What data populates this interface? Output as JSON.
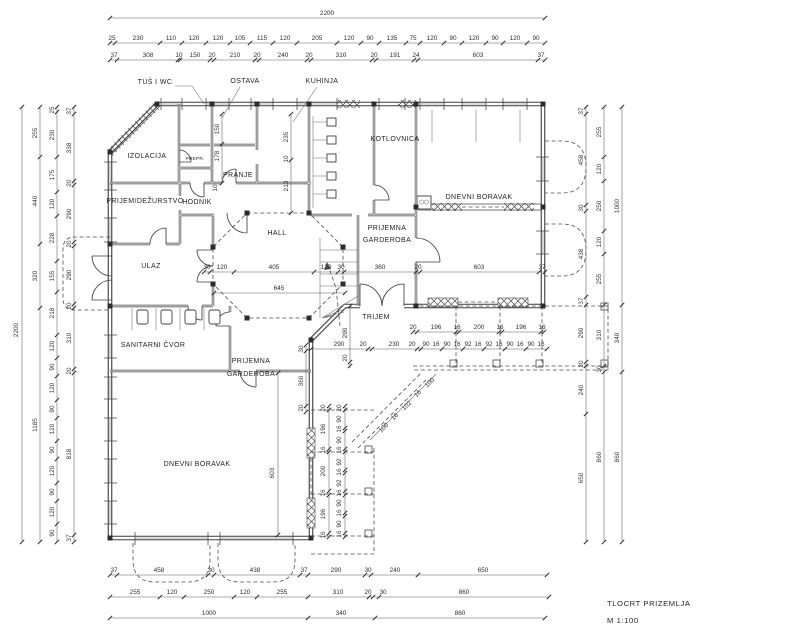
{
  "drawing": {
    "line_color": "#3c3c3c",
    "background": "#ffffff"
  },
  "title_block": {
    "name": "TLOCRT PRIZEMLJA",
    "scale": "M  1:100"
  },
  "rooms": {
    "tus_wc": "TUŠ I WC",
    "ostava": "OSTAVA",
    "kuhinja": "KUHINJA",
    "izolacija": "IZOLACIJA",
    "prepr": "PREPR.",
    "pranje": "PRANJE",
    "prijem": "PRIJEM/DEŽURSTVO",
    "hodnik": "HODNIK",
    "kotlovnica": "KOTLOVNICA",
    "hall": "HALL",
    "ulaz": "ULAZ",
    "trijem": "TRIJEM",
    "sanitarni": "SANITARNI ČVOR",
    "garderoba1a": "PRIJEMNA",
    "garderoba1b": "GARDEROBA",
    "garderoba2a": "PRIJEMNA",
    "garderoba2b": "GARDEROBA",
    "dnevni_desno": "DNEVNI BORAVAK",
    "dnevni_dolje": "DNEVNI BORAVAK"
  },
  "dims": {
    "top1": [
      "2200"
    ],
    "top2": [
      "25",
      "230",
      "110",
      "120",
      "120",
      "105",
      "115",
      "120",
      "205",
      "120",
      "90",
      "135",
      "75",
      "120",
      "90",
      "120",
      "90",
      "120",
      "90"
    ],
    "top3": [
      "37",
      "308",
      "10",
      "150",
      "20",
      "210",
      "20",
      "240",
      "20",
      "310",
      "20",
      "191",
      "24",
      "603",
      "37"
    ],
    "left1": [
      "2200"
    ],
    "left2": [
      "255",
      "440",
      "320",
      "1185"
    ],
    "left3": [
      "25",
      "230",
      "175",
      "120",
      "228",
      "155",
      "218",
      "120",
      "90",
      "120",
      "90",
      "120",
      "90",
      "120",
      "90",
      "120",
      "90"
    ],
    "left4": [
      "37",
      "338",
      "20",
      "290",
      "20",
      "290",
      "20",
      "310",
      "20",
      "818",
      "37"
    ],
    "right1": [
      "37",
      "458",
      "30",
      "438",
      "37",
      "290",
      "20",
      "240",
      "650"
    ],
    "right2": [
      "255",
      "120",
      "250",
      "120",
      "255",
      "310",
      "30",
      "860"
    ],
    "right3": [
      "1000",
      "340",
      "860"
    ],
    "bottom1": [
      "37",
      "458",
      "30",
      "438",
      "37",
      "290",
      "30",
      "240",
      "650"
    ],
    "bottom2": [
      "255",
      "120",
      "250",
      "120",
      "255",
      "310",
      "20",
      "30",
      "860"
    ],
    "bottom3": [
      "1000",
      "340",
      "860"
    ],
    "hall_row": [
      "30",
      "120",
      "405",
      "120",
      "30",
      "360",
      "20",
      "603",
      "37"
    ],
    "hall_total": [
      "645"
    ],
    "porch_row": [
      "290",
      "20",
      "230",
      "20"
    ],
    "porch_v": [
      "290",
      "20"
    ],
    "terrace_r1": [
      "20",
      "196",
      "16",
      "200",
      "16",
      "196",
      "16"
    ],
    "terrace_r2": [
      "90",
      "16",
      "90",
      "16",
      "92",
      "16",
      "92",
      "16",
      "90",
      "16",
      "90",
      "16"
    ],
    "terrace_b1": [
      "20",
      "196",
      "16",
      "200",
      "16",
      "196",
      "16"
    ],
    "terrace_b2": [
      "20",
      "90",
      "16",
      "90",
      "16",
      "92",
      "16",
      "92",
      "16",
      "90",
      "16",
      "90",
      "16"
    ],
    "diag": [
      "100",
      "16",
      "102",
      "16",
      "100"
    ],
    "kitchen_v": [
      "235",
      "10",
      "213"
    ],
    "pantry_v": [
      "150",
      "178"
    ],
    "hodnik_v": [
      "10"
    ],
    "garderoba_v": [
      "30",
      "360",
      "20"
    ],
    "living_v": [
      "603"
    ]
  }
}
